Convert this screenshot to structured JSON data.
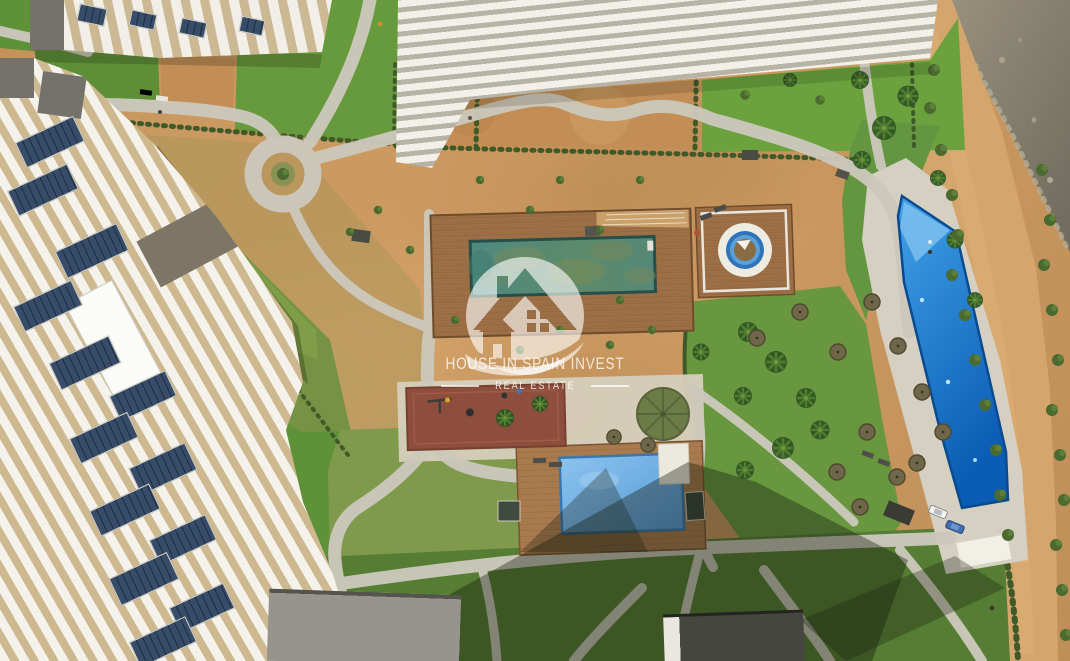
{
  "window": {
    "width": 1070,
    "height": 661
  },
  "photo": {
    "kind": "aerial-drone-photograph",
    "subject": "Seafront residential resort complex under landscaping, top-down view",
    "scene_labels": [
      "white apartment buildings with louvered pergola roofs",
      "apartment roof with solar panels",
      "main pool with teal water on wooden deck",
      "circular spa platform on wooden deck",
      "long blue infinity lap pool with concrete surround",
      "children's square pool on wooden deck",
      "playground with red rubber surface",
      "green parasol and straw parasols",
      "lawns with palm trees and hedges",
      "winding concrete footpaths and circular path junction",
      "coastal dirt road, shrubs and rocky shore",
      "building shadows",
      "parked cars on pool deck",
      "orange building at left edge"
    ]
  },
  "watermark": {
    "title": "HOUSE IN SPAIN INVEST",
    "subtitle": "REAL ESTATE",
    "logo": "house-silhouette-in-circle-with-swoosh"
  },
  "palette": {
    "dirt": "#c6955e",
    "road_sand": "#d4a56c",
    "path_concrete": "#ccc8bb",
    "grass_bright": "#6aa03d",
    "grass_mid": "#5f9139",
    "grass_shadow": "#4e7230",
    "grass_olive": "#9a9456",
    "pool_main_teal": "#54887a",
    "pool_lap_blue": "#1479cf",
    "pool_kids_blue": "#6fb0e4",
    "deck_wood": "#9b6e45",
    "playground_rubber": "#8e4e3d",
    "building_white": "#f2f0e8",
    "building_stripe_tan": "#cdb890",
    "solar_panel_navy": "#243449",
    "building_orange": "#e0a34b",
    "rock_grey": "#8d8674",
    "shrub_green": "#45632c",
    "shadow": "rgba(22,26,14,0.38)",
    "watermark_white": "rgba(255,255,255,0.75)"
  }
}
